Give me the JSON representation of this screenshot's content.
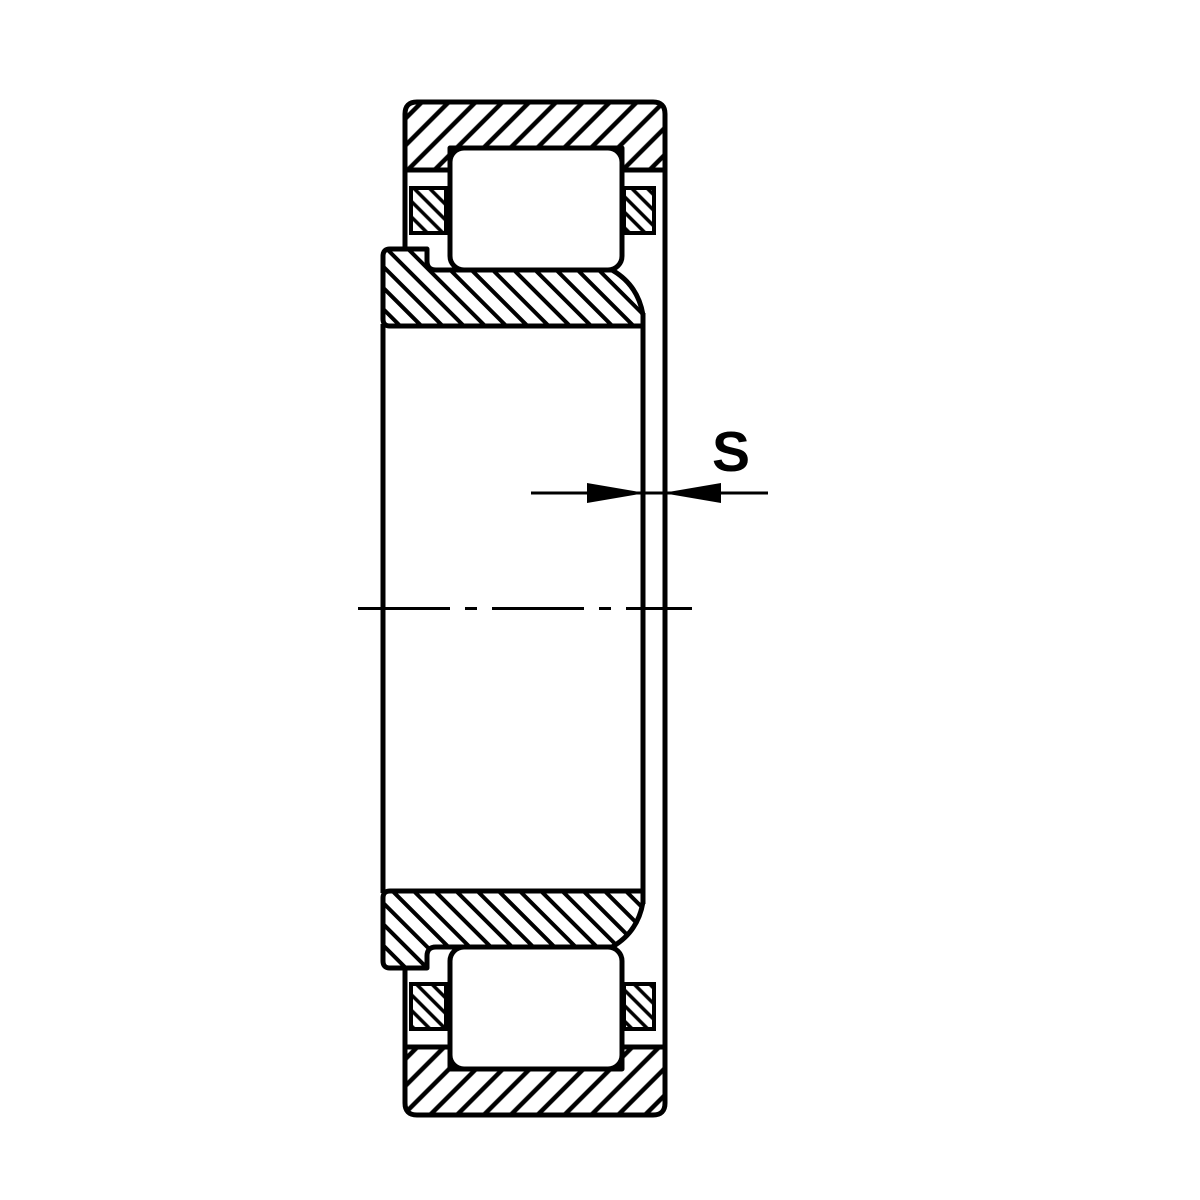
{
  "canvas": {
    "background": "#ffffff",
    "stroke_color": "#000000"
  },
  "drawing": {
    "kind": "cylindrical-roller-bearing-cross-section",
    "dimension_label": "S"
  }
}
